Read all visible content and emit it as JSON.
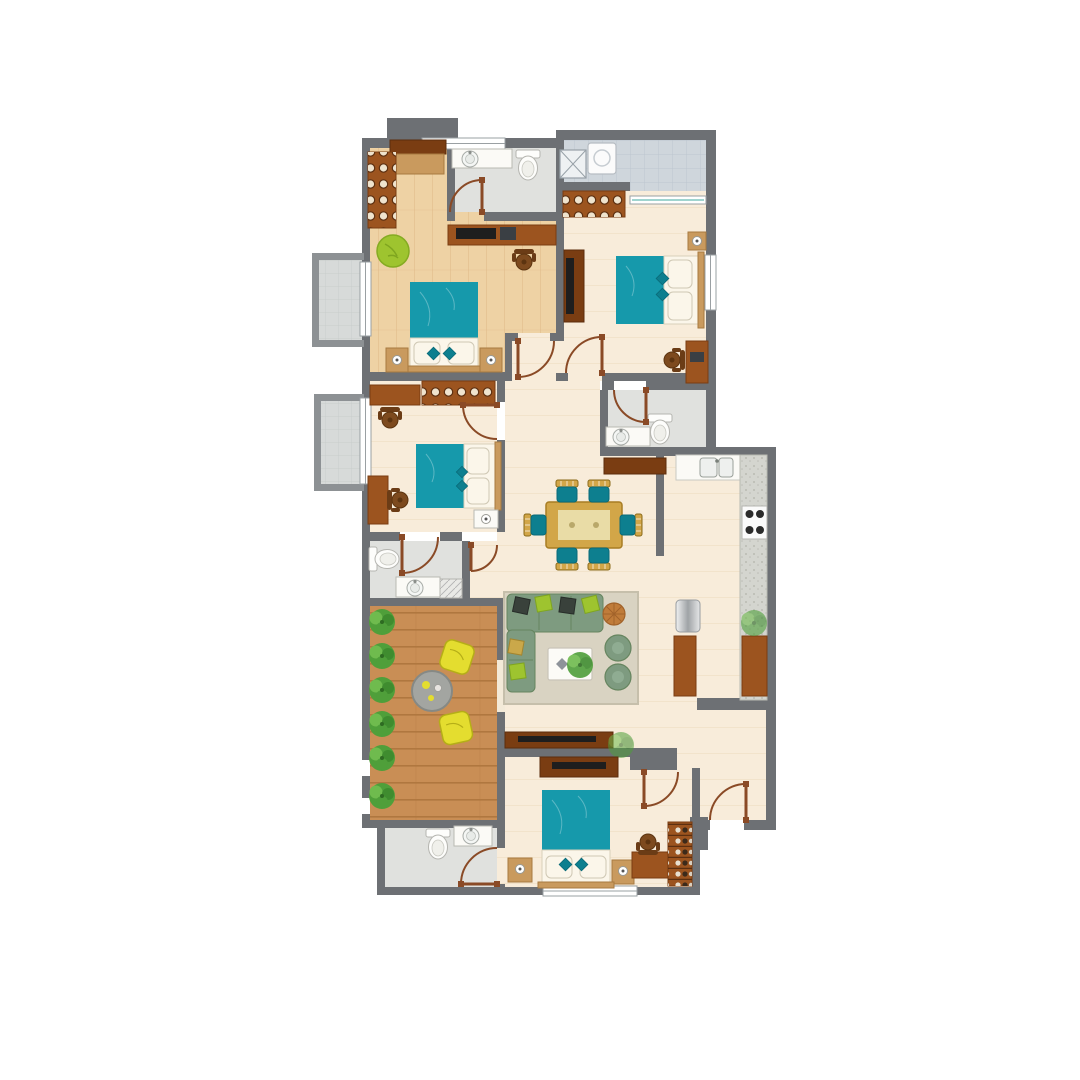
{
  "canvas": {
    "width": 1080,
    "height": 1080
  },
  "colors": {
    "wall": "#6d7074",
    "wallLight": "#8d9194",
    "cream": "#f8ecda",
    "creamLine": "#f0e1c7",
    "wood": "#eed2a4",
    "woodLine": "#ddb886",
    "bathFloor": "#e0e1de",
    "tileUtility": "#cfd6dc",
    "tileUtilityLine": "#b9c3cc",
    "tileBalcony": "#d7dad9",
    "tileBalconyLine": "#c5c9c8",
    "deck": "#c98e55",
    "deckLine": "#b0773f",
    "counter": "#d4d5cf",
    "counterDot": "#b2b3aa",
    "brown": "#9c541f",
    "brownDark": "#7a3d12",
    "tan": "#c99a5e",
    "tanDark": "#a87a40",
    "teal": "#1699ab",
    "tealDark": "#0d7f8f",
    "bedWhite": "#fbf6ea",
    "sofa": "#7e9b80",
    "sofaDark": "#66855f",
    "rug": "#d9d3c2",
    "rugEdge": "#c6bfab",
    "lime": "#9ec42f",
    "yellow": "#e4dd2f",
    "yellowDark": "#b5ae17",
    "tableGold": "#d2a648",
    "tableInner": "#e9dca6",
    "plantGreen": "#4f9f3a",
    "plantLight": "#6fbb4e",
    "plantDark": "#3f8c2f",
    "pouf": "#c07c3a",
    "door": "#8a4a26",
    "windowLine": "#9aa0a3",
    "white": "#ffffff",
    "tvBlack": "#1e1e1e",
    "metal": "#c7cacd"
  },
  "legend": {
    "rooms": [
      "bedroom-1-wood-floor",
      "ensuite-bathroom",
      "utility-balcony",
      "bedroom-2",
      "bedroom-3",
      "bathroom-2",
      "bathroom-3",
      "kitchen",
      "dining-area",
      "living-area",
      "terrace-deck",
      "bathroom-4",
      "master-bedroom",
      "entry-foyer",
      "balcony-1",
      "balcony-2"
    ],
    "furniture_counts": {
      "beds": 4,
      "wardrobes": 3,
      "desks": 5,
      "office_chairs": 5,
      "dining_chairs": 6,
      "sofa_armchairs": 2,
      "toilets": 4,
      "wash_basins": 5,
      "washing_machines": 1,
      "refrigerators": 1,
      "stove_burners": 4,
      "terrace_plants": 6,
      "terrace_chairs": 2,
      "interior_doors": 9,
      "entry_doors": 1
    }
  }
}
